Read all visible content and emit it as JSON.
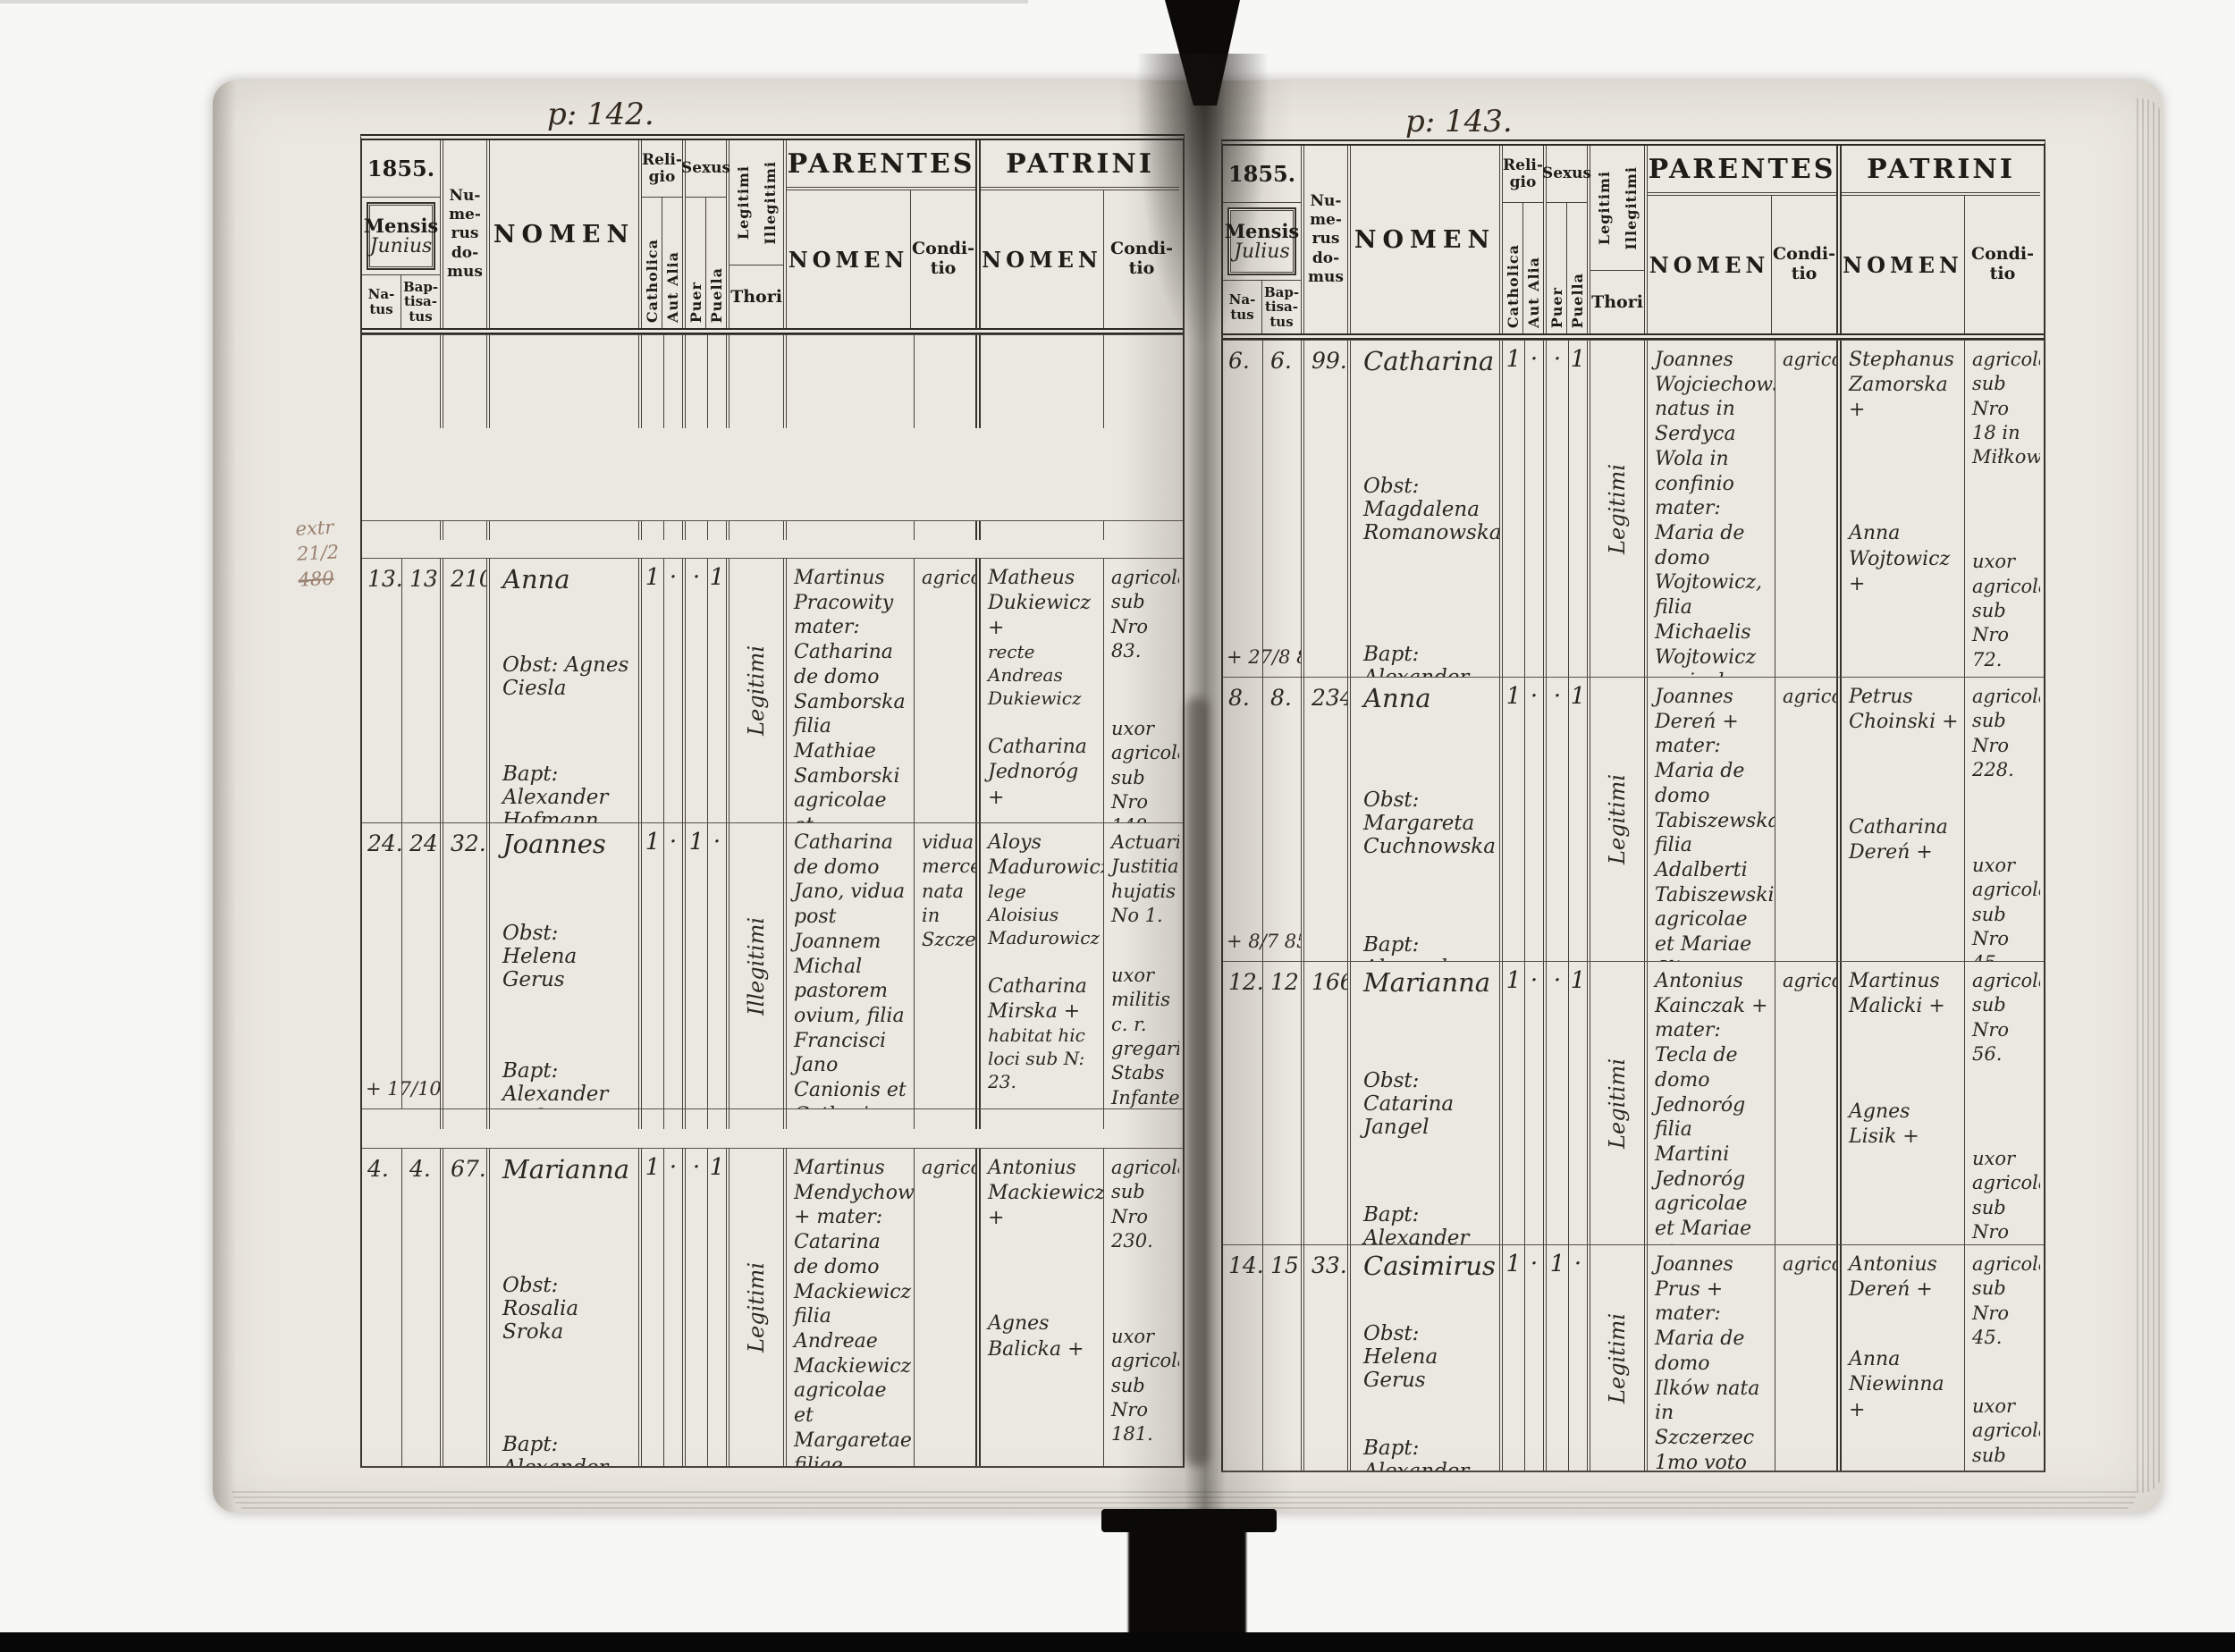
{
  "document": {
    "header_labels": {
      "year": "1855.",
      "mensis": "Mensis",
      "natus": "Na- tus",
      "baptisatus": "Bap- tisa- tus",
      "numerus_domus": "Nu- me- rus do- mus",
      "nomen": "NOMEN",
      "religio": "Reli- gio",
      "catholica": "Catholica",
      "aut_alia": "Aut Alia",
      "sexus": "Sexus",
      "puer": "Puer",
      "puella": "Puella",
      "legitimi": "Legitimi",
      "illegitimi": "Illegitimi",
      "thori": "Thori",
      "parentes": "PARENTES",
      "patrini": "PATRINI",
      "conditio": "Condi- tio"
    },
    "left_page": {
      "page_number": "p: 142.",
      "month": "Junius",
      "margin_note_1": "extr",
      "margin_note_2": "21/2",
      "margin_note_3": "480",
      "visitation": {
        "line1": "Vidimus in Visitatione Nostra generali canonica. —",
        "line2": "Datum in pago Siemianówka die 11. Junii 1855.",
        "signature": "Lucas Archieppus."
      },
      "section_heading_1": "Junius 1855.",
      "section_heading_2": "Mensis Julius 1855.",
      "rows": [
        {
          "natus": "13.",
          "baptisatus": "13.",
          "domus": "210.",
          "nomen": "Anna",
          "obstetrix": "Obst: Agnes Ciesla",
          "baptizans": "Bapt: Alexander Hofmann",
          "baptizans_2": "Curatus loci",
          "death_note": "",
          "catholica": "1",
          "aut_alia": "·",
          "puer": "·",
          "puella": "1",
          "thori": "Legitimi",
          "parentes_nomen": "Martinus Pracowity mater: Catharina de domo Samborska filia Mathiae Samborski agricolae et Mariannae filiae Petri Jednoróg et Mariannae",
          "parentes_conditio": "agricola",
          "patrini": [
            {
              "name": "Matheus Dukiewicz +",
              "note": "recte Andreas Dukiewicz",
              "conditio": "agricola sub Nro 83."
            },
            {
              "name": "Catharina Jednoróg +",
              "note": "",
              "conditio": "uxor agricolae sub Nro 148."
            }
          ]
        },
        {
          "natus": "24.",
          "baptisatus": "24.",
          "domus": "32.",
          "nomen": "Joannes",
          "obstetrix": "Obst: Helena Gerus",
          "baptizans": "Bapt: Alexander Hofmann",
          "baptizans_2": "Curatus loci",
          "death_note": "+ 17/10 855.",
          "catholica": "1",
          "aut_alia": "·",
          "puer": "1",
          "puella": "·",
          "thori": "Illegitimi",
          "parentes_nomen": "Catharina de domo Jano, vidua post Joannem Michal pastorem ovium, filia Francisci Jano Canionis et Catharinae natae Barszczowska.",
          "parentes_conditio": "vidua mercenaria, nata in Szczerzec",
          "patrini": [
            {
              "name": "Aloys Madurowicz",
              "note": "lege Aloisius Madurowicz",
              "conditio": "Actuarius Justitiariatus hujatis No 1."
            },
            {
              "name": "Catharina Mirska +",
              "note": "habitat hic loci sub N: 23.",
              "conditio": "uxor militis c. r. gregarii Stabs Infanteria 2. Comp."
            }
          ]
        },
        {
          "natus": "4.",
          "baptisatus": "4.",
          "domus": "67.",
          "nomen": "Marianna",
          "obstetrix": "Obst: Rosalia Sroka",
          "baptizans": "Bapt: Alexander Hofmann",
          "baptizans_2": "Curatus loci",
          "death_note": "",
          "catholica": "1",
          "aut_alia": "·",
          "puer": "·",
          "puella": "1",
          "thori": "Legitimi",
          "parentes_nomen": "Martinus Mendychowski + mater: Catarina de domo Mackiewicz filia Andreae Mackiewicz agricolae et Margaretae filiae Gregorii Lisik et Mariae, Jednoróg",
          "parentes_conditio": "agricola",
          "patrini": [
            {
              "name": "Antonius Mackiewicz +",
              "note": "",
              "conditio": "agricola sub Nro 230."
            },
            {
              "name": "Agnes Balicka +",
              "note": "",
              "conditio": "uxor agricolae sub Nro 181."
            }
          ]
        }
      ]
    },
    "right_page": {
      "page_number": "p: 143.",
      "month": "Julius",
      "rows": [
        {
          "natus": "6.",
          "baptisatus": "6.",
          "domus": "99.",
          "nomen": "Catharina",
          "obstetrix": "Obst: Magdalena Romanowska",
          "baptizans": "Bapt: Alexander Hofmann",
          "baptizans_2": "Curatus loci",
          "death_note": "+ 27/8 855.",
          "catholica": "1",
          "aut_alia": "·",
          "puer": "·",
          "puella": "1",
          "thori": "Legitimi",
          "parentes_nomen": "Joannes Wojciechowski, natus in Serdyca Wola in confinio mater: Maria de domo Wojtowicz, filia Michaelis Wojtowicz agricolae et Anastasiae filiae Joannis Zamorska et Mariannae Nowak.",
          "parentes_conditio": "agricola",
          "patrini": [
            {
              "name": "Stephanus Zamorska +",
              "note": "",
              "conditio": "agricola sub Nro 18 in Miłkowiu"
            },
            {
              "name": "Anna Wojtowicz +",
              "note": "",
              "conditio": "uxor agricolae sub Nro 72."
            }
          ]
        },
        {
          "natus": "8.",
          "baptisatus": "8.",
          "domus": "234.",
          "nomen": "Anna",
          "obstetrix": "Obst: Margareta Cuchnowska",
          "baptizans": "Bapt: Alexander Hofmann",
          "baptizans_2": "Curatus loci",
          "death_note": "+ 8/7 855.",
          "catholica": "1",
          "aut_alia": "·",
          "puer": "·",
          "puella": "1",
          "thori": "Legitimi",
          "parentes_nomen": "Joannes Dereń + mater: Maria de domo Tabiszewska, filia Adalberti Tabiszewski agricolae et Mariae filiae Francisci Bednarski et Mariae Chomin.",
          "parentes_conditio": "agricola",
          "patrini": [
            {
              "name": "Petrus Choinski +",
              "note": "",
              "conditio": "agricola sub Nro 228."
            },
            {
              "name": "Catharina Dereń +",
              "note": "",
              "conditio": "uxor agricolae sub Nro 45."
            }
          ]
        },
        {
          "natus": "12.",
          "baptisatus": "12.",
          "domus": "166.",
          "nomen": "Marianna",
          "obstetrix": "Obst: Catarina Jangel",
          "baptizans": "Bapt: Alexander Hofmann",
          "baptizans_2": "Curatus loci",
          "death_note": "",
          "catholica": "1",
          "aut_alia": "·",
          "puer": "·",
          "puella": "1",
          "thori": "Legitimi",
          "parentes_nomen": "Antonius Kainczak + mater: Tecla de domo Jednoróg filia Martini Jednoróg agricolae et Mariae filiae Simonis Makowiecki et Mariae de domo Mykitka",
          "parentes_conditio": "agricola",
          "patrini": [
            {
              "name": "Martinus Malicki +",
              "note": "",
              "conditio": "agricola sub Nro 56."
            },
            {
              "name": "Agnes Lisik +",
              "note": "",
              "conditio": "uxor agricolae sub Nro 154."
            }
          ]
        },
        {
          "natus": "14.",
          "baptisatus": "15.",
          "domus": "33.",
          "nomen": "Casimirus",
          "obstetrix": "Obst: Helena Gerus",
          "baptizans": "Bapt: Alexander Hofmann",
          "baptizans_2": "Curatus loci",
          "death_note": "",
          "catholica": "1",
          "aut_alia": "·",
          "puer": "1",
          "puella": "·",
          "thori": "Legitimi",
          "parentes_nomen": "Joannes Prus + mater: Maria de domo Ilków nata in Szczerzec 1mo voto Choinska, filia Basilii Ilków agricolae et Mariae filiae Mathiae Ilaszewicz.",
          "parentes_conditio": "agricola",
          "patrini": [
            {
              "name": "Antonius Dereń +",
              "note": "",
              "conditio": "agricola sub Nro 45."
            },
            {
              "name": "Anna Niewinna +",
              "note": "",
              "conditio": "uxor agricolae sub Nro 39."
            }
          ]
        }
      ]
    }
  }
}
